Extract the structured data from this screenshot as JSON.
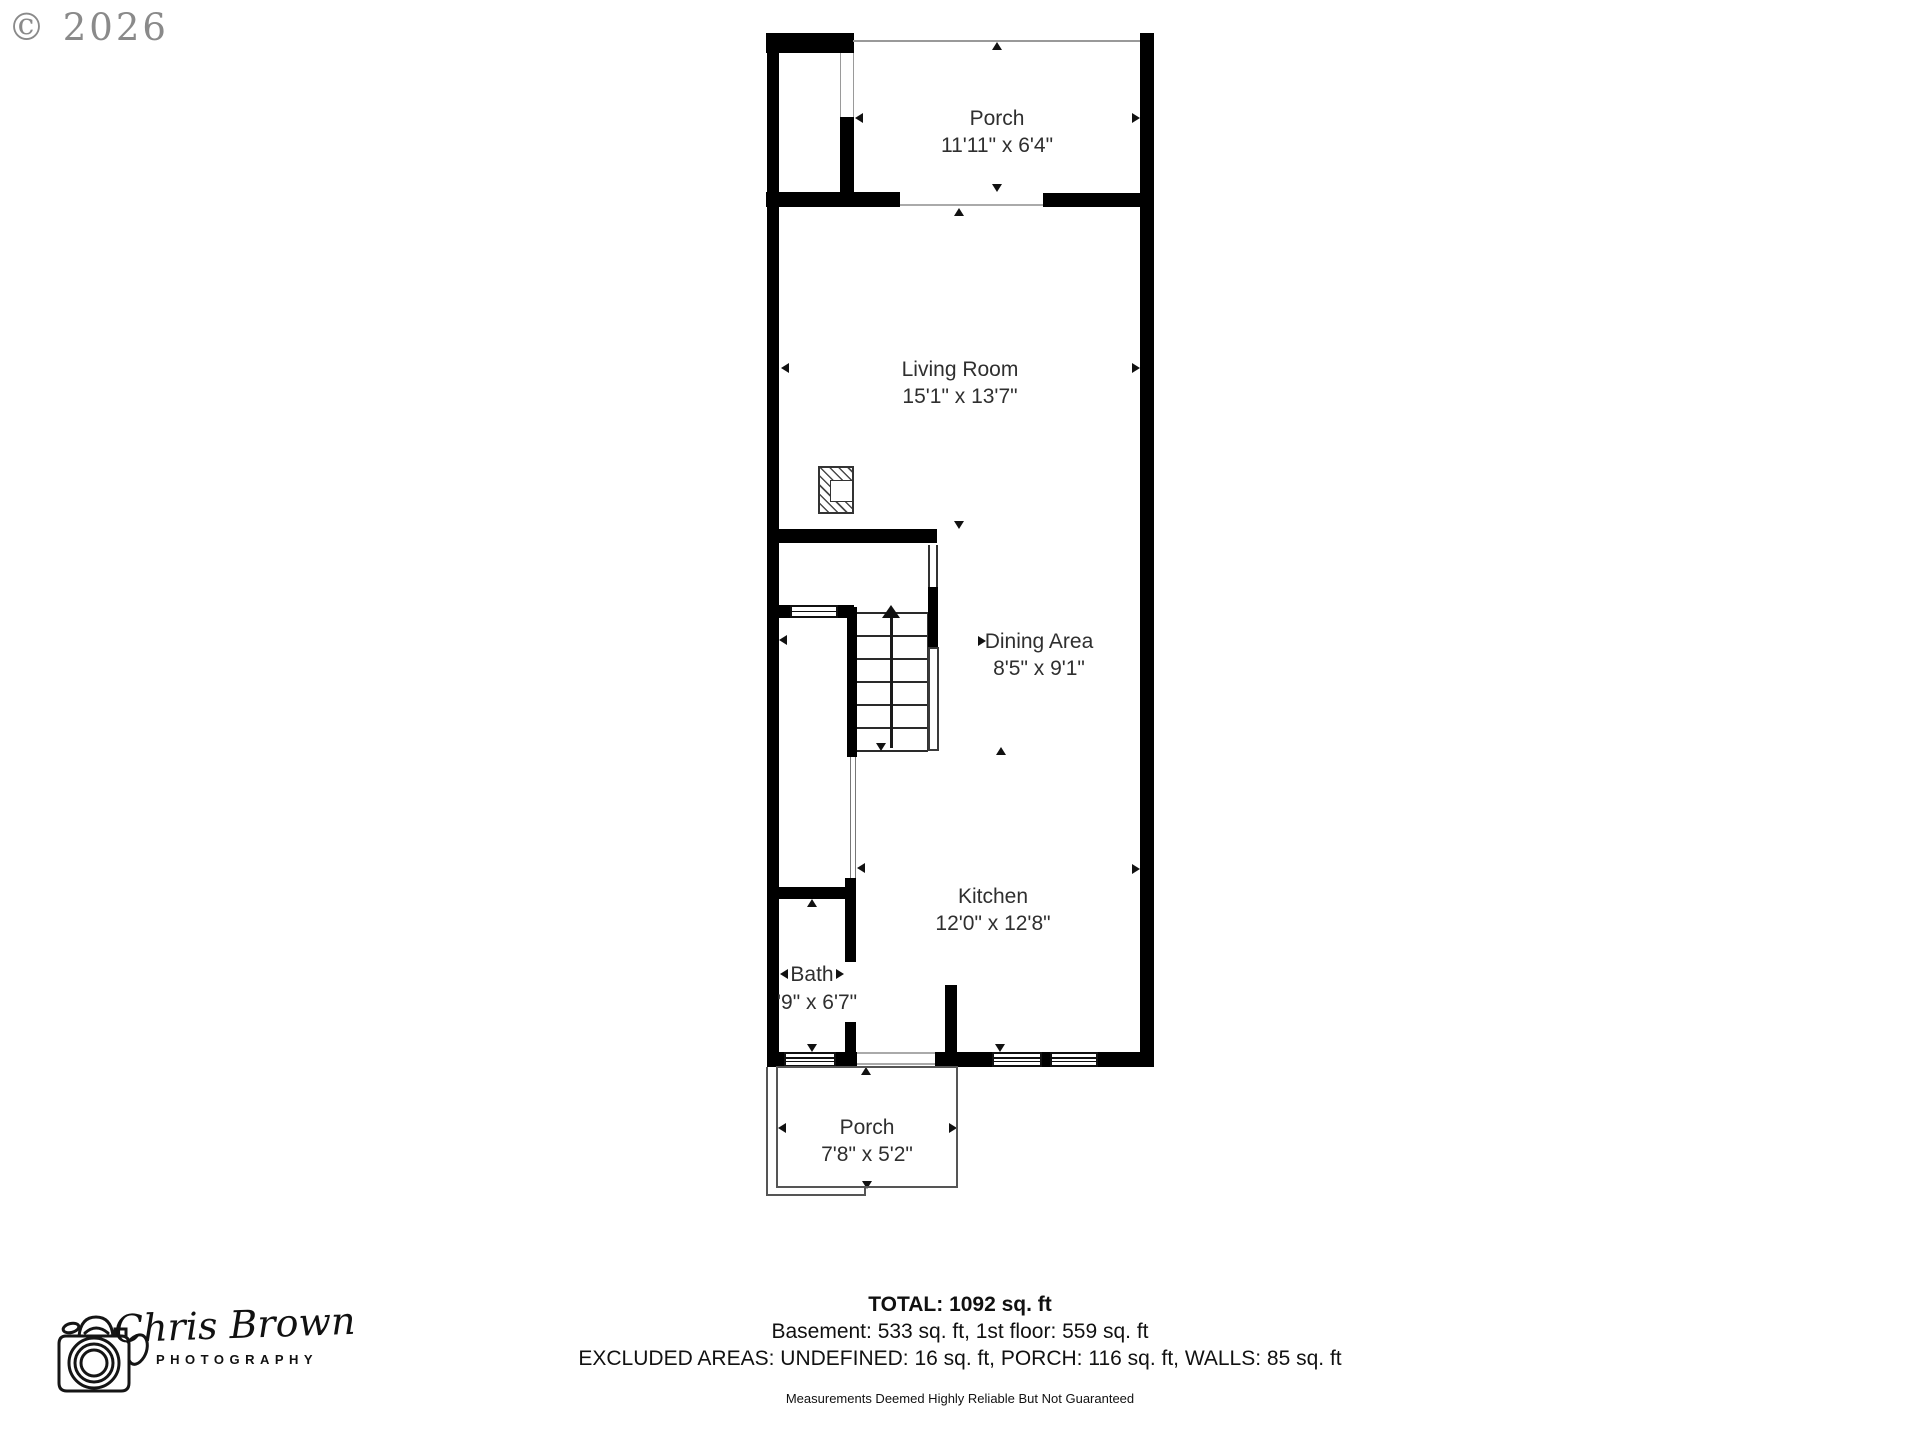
{
  "watermark": {
    "copyright": "© 2026"
  },
  "rooms": {
    "porch_top": {
      "name": "Porch",
      "dims": "11'11\" x 6'4\""
    },
    "living_room": {
      "name": "Living Room",
      "dims": "15'1\" x 13'7\""
    },
    "dining_area": {
      "name": "Dining Area",
      "dims": "8'5\" x 9'1\""
    },
    "kitchen": {
      "name": "Kitchen",
      "dims": "12'0\" x 12'8\""
    },
    "bath": {
      "name": "Bath",
      "dims": "'9\" x 6'7\""
    },
    "porch_bottom": {
      "name": "Porch",
      "dims": "7'8\" x 5'2\""
    }
  },
  "summary": {
    "total": "TOTAL: 1092 sq. ft",
    "floors": "Basement: 533 sq. ft, 1st floor: 559 sq. ft",
    "excluded": "EXCLUDED AREAS: UNDEFINED: 16 sq. ft, PORCH: 116 sq. ft, WALLS: 85 sq. ft",
    "disclaimer": "Measurements Deemed Highly Reliable But Not Guaranteed"
  },
  "logo": {
    "icon": "camera-sketch-icon",
    "name": "Chris Brown",
    "subtitle": "PHOTOGRAPHY"
  },
  "colors": {
    "wall": "#000000",
    "background": "#ffffff",
    "dimension_gray": "#999999",
    "watermark_gray": "#8a8a8a"
  }
}
